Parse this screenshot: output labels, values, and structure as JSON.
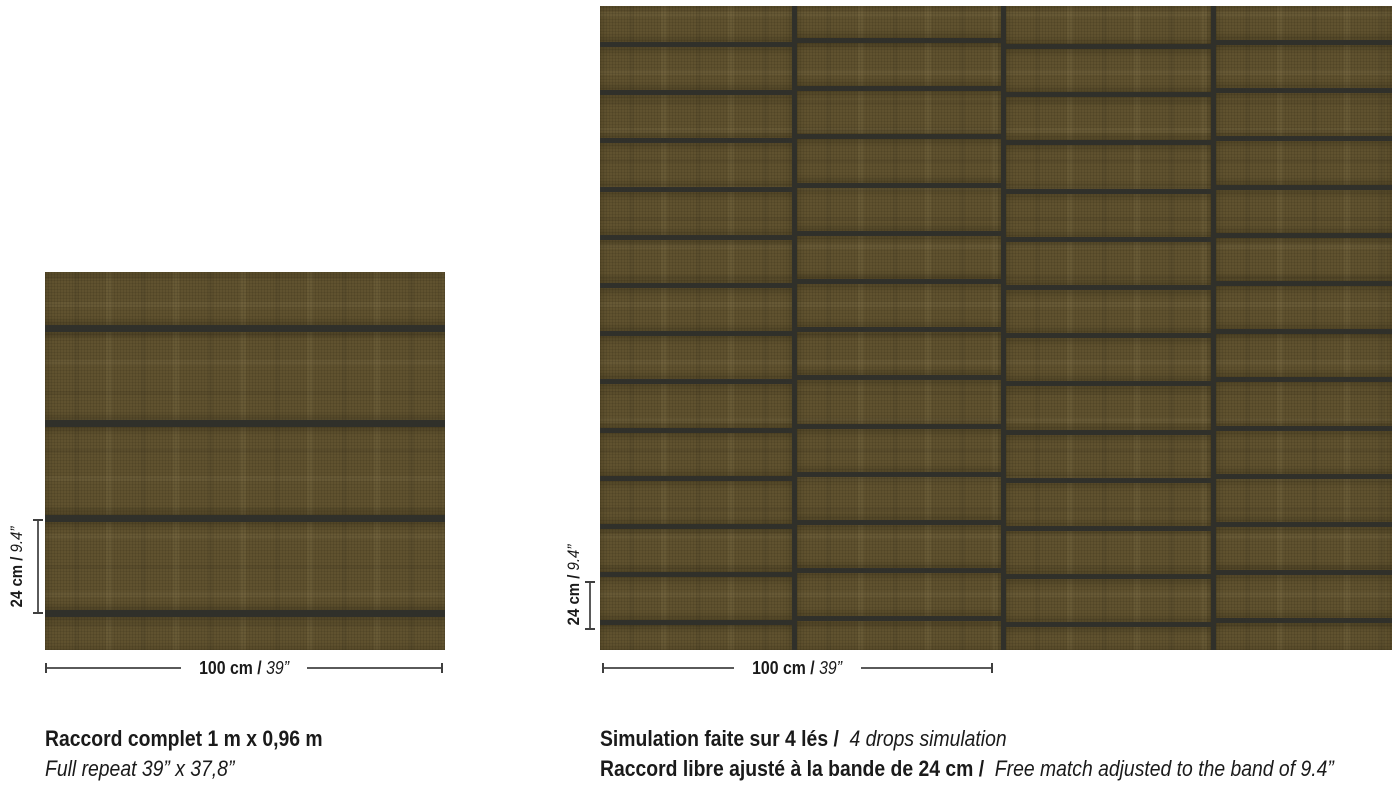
{
  "left_figure": {
    "vdim": {
      "bold": "24 cm",
      "italic": "9.4”"
    },
    "hdim": {
      "bold": "100 cm",
      "italic": "39”"
    },
    "caption_line1": "Raccord complet 1 m x 0,96 m",
    "caption_line2": "Full repeat 39” x 37,8”"
  },
  "right_figure": {
    "vdim": {
      "bold": "24 cm",
      "italic": "9.4”"
    },
    "hdim": {
      "bold": "100 cm",
      "italic": "39”"
    },
    "caption_line1_bold": "Simulation faite sur 4 lés /",
    "caption_line1_italic": "4 drops simulation",
    "caption_line2_bold": "Raccord libre ajusté à la bande de 24 cm /",
    "caption_line2_italic": "Free match adjusted to the band of 9.4”"
  },
  "pattern": {
    "field_color": "#60522f",
    "line_color": "#30302a",
    "swatch": {
      "width": 400,
      "height": 378,
      "line_positions": [
        53,
        148,
        243,
        338
      ],
      "line_thickness": 7
    },
    "simulation": {
      "width": 792,
      "height": 644,
      "column_widths": [
        192,
        204,
        205,
        176
      ],
      "separator_thickness": 5,
      "row_spacing": 48.2,
      "row_line_thickness": 5,
      "column_first_line_tops": [
        36,
        32,
        38,
        34
      ]
    }
  }
}
